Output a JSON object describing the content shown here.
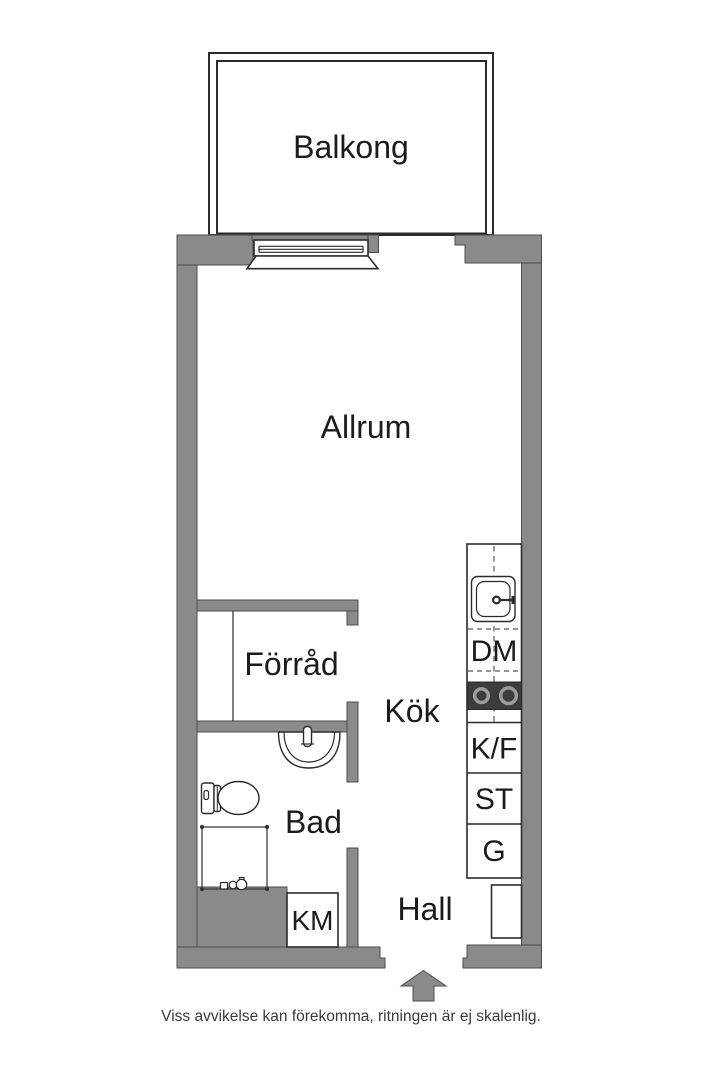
{
  "floor_plan": {
    "labels": {
      "balcony": "Balkong",
      "living_room": "Allrum",
      "storage": "Förråd",
      "kitchen": "Kök",
      "bathroom": "Bad",
      "hall": "Hall"
    },
    "appliance_labels": {
      "dishwasher": "DM",
      "fridge_freezer": "K/F",
      "tall_cabinet": "ST",
      "wardrobe": "G",
      "washing_machine": "KM"
    },
    "footer": {
      "disclaimer": "Viss avvikelse kan förekomma, ritningen är ej skalenlig."
    },
    "colors": {
      "background": "#FFFFFF",
      "wall": "#8A8A8A",
      "wall_outline": "#4D4D4D",
      "line": "#2B2B2B",
      "text": "#1B1B1B",
      "muted_text": "#3B3B3B",
      "stove": "#3C3C3C",
      "burner_ring": "#9C9C9C"
    }
  }
}
